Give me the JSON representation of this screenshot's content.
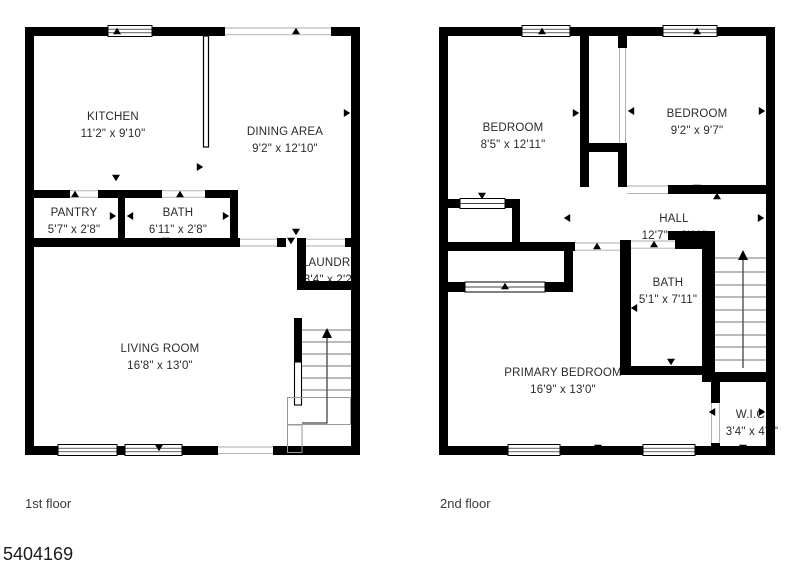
{
  "page": {
    "width": 800,
    "height": 571,
    "background": "#ffffff",
    "watermark": "5404169"
  },
  "colors": {
    "wall": "#000000",
    "room_text": "#2b2b2b",
    "caption_text": "#3a3a3a",
    "opening_line": "#aaaaaa",
    "stair_line": "#777777",
    "arrow_line": "#444444"
  },
  "floors": [
    {
      "caption": "1st floor",
      "caption_pos": {
        "x": 25,
        "y": 496
      },
      "rooms": [
        {
          "name": "KITCHEN",
          "dims": "11'2\" x 9'10\"",
          "cx": 113,
          "cy": 109
        },
        {
          "name": "DINING AREA",
          "dims": "9'2\" x 12'10\"",
          "cx": 285,
          "cy": 124
        },
        {
          "name": "PANTRY",
          "dims": "5'7\" x 2'8\"",
          "cx": 74,
          "cy": 205
        },
        {
          "name": "BATH",
          "dims": "6'11\" x 2'8\"",
          "cx": 178,
          "cy": 205
        },
        {
          "name": "LAUNDRY",
          "dims": "3'4\" x 2'2\"",
          "cx": 330,
          "cy": 255
        },
        {
          "name": "LIVING ROOM",
          "dims": "16'8\" x 13'0\"",
          "cx": 160,
          "cy": 341
        }
      ]
    },
    {
      "caption": "2nd floor",
      "caption_pos": {
        "x": 440,
        "y": 496
      },
      "rooms": [
        {
          "name": "BEDROOM",
          "dims": "8'5\" x 12'11\"",
          "cx": 513,
          "cy": 120
        },
        {
          "name": "BEDROOM",
          "dims": "9'2\" x 9'7\"",
          "cx": 697,
          "cy": 106
        },
        {
          "name": "HALL",
          "dims": "12'7\" x 2'11\"",
          "cx": 674,
          "cy": 211
        },
        {
          "name": "BATH",
          "dims": "5'1\" x 7'11\"",
          "cx": 668,
          "cy": 275
        },
        {
          "name": "PRIMARY BEDROOM",
          "dims": "16'9\" x 13'0\"",
          "cx": 563,
          "cy": 365
        },
        {
          "name": "W.I.C.",
          "dims": "3'4\" x 4'9\"",
          "cx": 752,
          "cy": 407
        }
      ]
    }
  ]
}
